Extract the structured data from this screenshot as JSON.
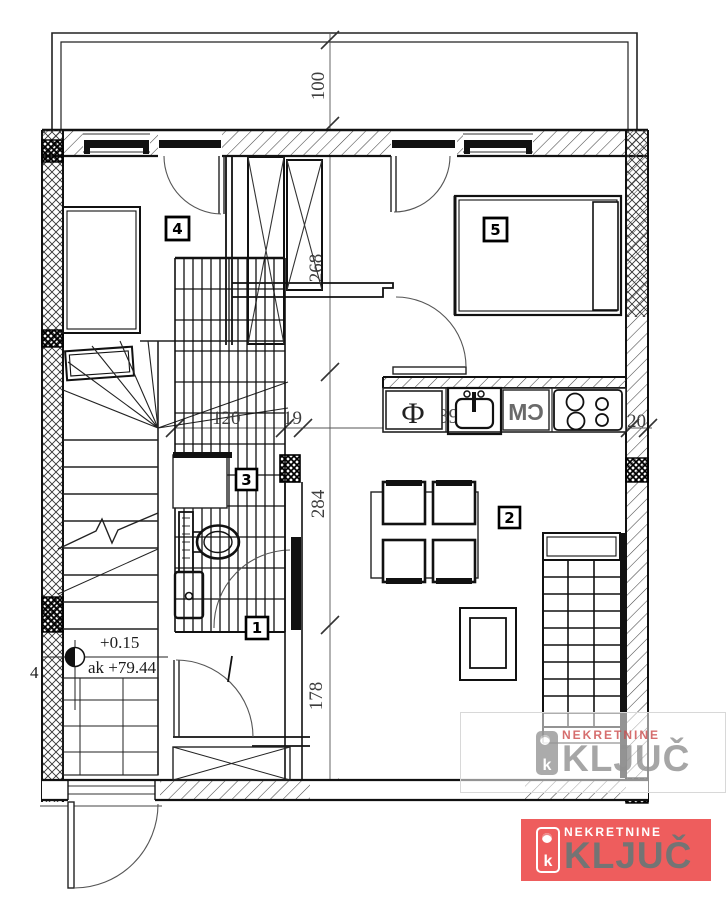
{
  "plan": {
    "rooms": [
      {
        "label": "1"
      },
      {
        "label": "2"
      },
      {
        "label": "3"
      },
      {
        "label": "4"
      },
      {
        "label": "5"
      }
    ],
    "dims_vertical": [
      "100",
      "268",
      "284",
      "178"
    ],
    "dims_horizontal": [
      "120",
      "19",
      "391",
      "20"
    ],
    "dim_cut": "4",
    "elevation": {
      "relative": "+0.15",
      "absolute": "ak +79.44"
    },
    "kitchen": {
      "fridge": "Ф",
      "appliance": "СМ"
    }
  },
  "logo": {
    "top": "NEKRETNINE",
    "main": "KLJUČ",
    "key_letter": "k",
    "colors": {
      "red": "#cc4b4b",
      "salmon_bg": "#ee5d5d",
      "gray": "#909090",
      "gray_on_red": "#747474"
    }
  }
}
